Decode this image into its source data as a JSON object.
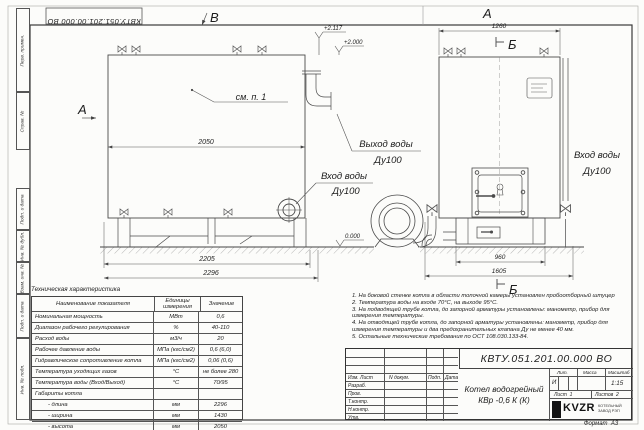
{
  "sheet": {
    "doc_number_rotated": "КВТУ.051.201.00.000 ВО",
    "format_label": "Формат",
    "format_value": "А3"
  },
  "stamps": [
    "Перв. примен.",
    "Справ. №",
    "Подп. и дата",
    "Инв. № дубл.",
    "Взам. инв. №",
    "Подп. и дата",
    "Инв. № подл."
  ],
  "drawing": {
    "view_labels": {
      "a": "А",
      "b_top": "Б",
      "v": "В",
      "b_bottom": "Б"
    },
    "callout_note": "см. п. 1",
    "levels": {
      "top": "+2.117",
      "body": "+2.000",
      "zero": "0.000"
    },
    "dims": {
      "body_length": "2050",
      "front_width": "1260",
      "base_length": "2205",
      "overall_length": "2296",
      "base_width": "960",
      "overall_width": "1605"
    },
    "port_labels": {
      "outlet_line1": "Выход воды",
      "outlet_line2": "Ду100",
      "inlet_left_line1": "Вход воды",
      "inlet_left_line2": "Ду100",
      "inlet_right_line1": "Вход воды",
      "inlet_right_line2": "Ду100"
    }
  },
  "tech_table": {
    "title": "Техническая характеристика",
    "headers": [
      "Наименование показателя",
      "Единицы измерения",
      "Значение"
    ],
    "rows": [
      [
        "Номинальная мощность",
        "МВт",
        "0,6"
      ],
      [
        "Диапазон рабочего регулирования",
        "%",
        "40-110"
      ],
      [
        "Расход воды",
        "м3/ч",
        "20"
      ],
      [
        "Рабочее давление воды",
        "МПа (кгс/см2)",
        "0,6 (6,0)"
      ],
      [
        "Гидравлическое сопротивление котла",
        "МПа (кгс/см2)",
        "0,06 (0,6)"
      ],
      [
        "Температура уходящих газов",
        "°С",
        "не более 280"
      ],
      [
        "Температура воды (Вход/Выход)",
        "°С",
        "70/95"
      ],
      [
        "Габариты котла",
        "",
        ""
      ],
      [
        "- длина",
        "мм",
        "2296"
      ],
      [
        "- ширина",
        "мм",
        "1430"
      ],
      [
        "- высота",
        "мм",
        "2050"
      ]
    ]
  },
  "notes": [
    "1.  На боковой стенке котла в области топочной камеры установлен пробоотборный штуцер",
    "2.  Температура воды на входе 70°С, на выходе 95°С.",
    "3.  На подводящей трубе котла, до запорной арматуры установлены: манометр, прибор для измерения температуры.",
    "4.  На отводящей трубе котла, до запорной арматуры установлены: манометр, прибор для измерения температуры и два предохранительных клапана Ду не менее 40 мм.",
    "5.  Остальные технические требования по ОСТ 108.030.133-84."
  ],
  "title_block": {
    "doc_number": "КВТУ.051.201.00.000 ВО",
    "product_title_line1": "Котел водогрейный",
    "product_title_line2": "КВр -0,6  К  (К)",
    "header_cells": [
      "Изм. Лист",
      "N докум.",
      "Подп.",
      "Дата"
    ],
    "row_labels": [
      "Разраб.",
      "Пров.",
      "Т.контр.",
      "Н.контр.",
      "Утв."
    ],
    "lit_label": "Лит.",
    "lit_value": "И",
    "mass_label": "Масса",
    "mass_value": "",
    "scale_label": "Масштаб",
    "scale_value": "1:15",
    "sheet_label": "Лист",
    "sheet_value": "1",
    "sheets_label": "Листов",
    "sheets_value": "2",
    "logo_text": "KVZR",
    "logo_caption_line1": "КОТЕЛЬНЫЙ",
    "logo_caption_line2": "ЗАВОД РЭП"
  }
}
